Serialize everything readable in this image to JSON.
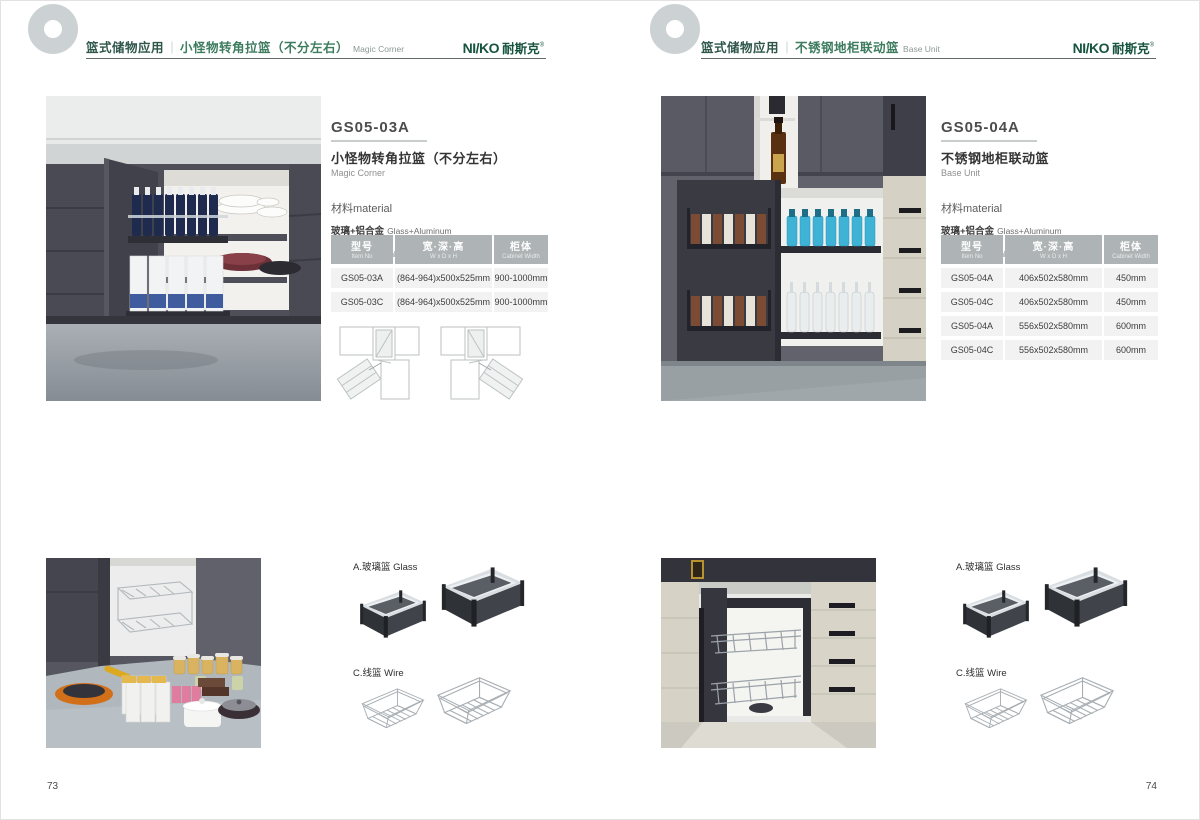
{
  "colors": {
    "accent_green": "#3D7C5F",
    "logo_green": "#17543F",
    "table_header_bg": "#AEB3B5",
    "table_row_bg": "#F1F2F1",
    "watermark_gray": "#CCD2D3"
  },
  "brand": {
    "name_en": "NI/KO",
    "name_cn": "耐斯克",
    "registered": "®"
  },
  "pages": {
    "left": {
      "page_number": "73",
      "header": {
        "category": "篮式储物应用",
        "divider": "｜",
        "title_cn": "小怪物转角拉篮（不分左右）",
        "title_en": "Magic Corner"
      },
      "product": {
        "model": "GS05-03A",
        "name_cn": "小怪物转角拉篮（不分左右）",
        "name_en": "Magic Corner",
        "material_label": "材料material",
        "material1_cn": "玻璃+铝合金",
        "material1_en": "Glass+Aluminum",
        "material2_cn": "不锈钢/铁",
        "material2_en": "Stainless SteeL/Iron"
      },
      "table": {
        "h1_cn": "型号",
        "h1_en": "Item No",
        "h2_cn": "宽·深·高",
        "h2_en": "W x D x H",
        "h3_cn": "柜体",
        "h3_en": "Cabinet Width",
        "rows": [
          [
            "GS05-03A",
            "(864-964)x500x525mm",
            "900-1000mm"
          ],
          [
            "GS05-03C",
            "(864-964)x500x525mm",
            "900-1000mm"
          ]
        ]
      },
      "accessories": {
        "glass": "A.玻璃篮 Glass",
        "wire": "C.线篮 Wire"
      }
    },
    "right": {
      "page_number": "74",
      "header": {
        "category": "篮式储物应用",
        "divider": "｜",
        "title_cn": "不锈钢地柜联动篮",
        "title_en": "Base Unit"
      },
      "product": {
        "model": "GS05-04A",
        "name_cn": "不锈钢地柜联动篮",
        "name_en": "Base Unit",
        "material_label": "材料material",
        "material1_cn": "玻璃+铝合金",
        "material1_en": "Glass+Aluminum",
        "material2_cn": "不锈钢/铁",
        "material2_en": "Stainless SteeL/Iron"
      },
      "table": {
        "h1_cn": "型号",
        "h1_en": "Item No",
        "h2_cn": "宽·深·高",
        "h2_en": "W x D x H",
        "h3_cn": "柜体",
        "h3_en": "Cabinet Width",
        "rows": [
          [
            "GS05-04A",
            "406x502x580mm",
            "450mm"
          ],
          [
            "GS05-04C",
            "406x502x580mm",
            "450mm"
          ],
          [
            "GS05-04A",
            "556x502x580mm",
            "600mm"
          ],
          [
            "GS05-04C",
            "556x502x580mm",
            "600mm"
          ]
        ]
      },
      "accessories": {
        "glass": "A.玻璃篮 Glass",
        "wire": "C.线篮 Wire"
      }
    }
  }
}
